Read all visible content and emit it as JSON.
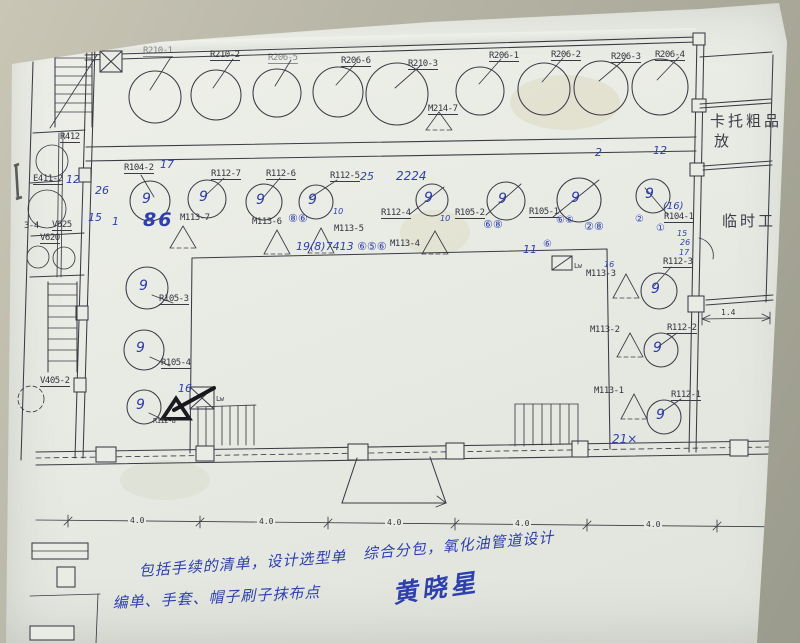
{
  "photo": {
    "background_color": "#b7b5a6",
    "paper_color": "#e9ece5",
    "ink_color": "#3a3b45",
    "pen_color": "#2e3fae"
  },
  "drawing": {
    "vessel_mark": "9",
    "vessels": [
      [
        155,
        97,
        26,
        [
          171,
          57,
          150,
          90
        ],
        0
      ],
      [
        216,
        95,
        25,
        [
          233,
          59,
          213,
          88
        ],
        0
      ],
      [
        277,
        93,
        24,
        [
          291,
          60,
          275,
          86
        ],
        0
      ],
      [
        338,
        92,
        25,
        [
          356,
          63,
          336,
          85
        ],
        0
      ],
      [
        397,
        94,
        31,
        [
          420,
          66,
          395,
          88
        ],
        0
      ],
      [
        480,
        91,
        24,
        [
          501,
          59,
          479,
          84
        ],
        0
      ],
      [
        544,
        89,
        26,
        [
          563,
          58,
          542,
          82
        ],
        0
      ],
      [
        601,
        88,
        27,
        [
          625,
          59,
          599,
          81
        ],
        0
      ],
      [
        660,
        87,
        28,
        [
          679,
          57,
          657,
          80
        ],
        0
      ],
      [
        150,
        201,
        20,
        [
          141,
          175,
          154,
          197
        ],
        1
      ],
      [
        207,
        199,
        19,
        [
          224,
          178,
          206,
          195
        ],
        1
      ],
      [
        264,
        202,
        18,
        [
          280,
          178,
          263,
          198
        ],
        1
      ],
      [
        316,
        202,
        17,
        [
          337,
          180,
          310,
          198
        ],
        1
      ],
      [
        432,
        200,
        16,
        [
          410,
          214,
          444,
          187
        ],
        1
      ],
      [
        506,
        201,
        19,
        [
          486,
          215,
          521,
          184
        ],
        1
      ],
      [
        579,
        200,
        22,
        [
          553,
          217,
          599,
          180
        ],
        1
      ],
      [
        653,
        196,
        17,
        [
          668,
          215,
          645,
          188
        ],
        1
      ],
      [
        147,
        288,
        21,
        [
          152,
          295,
          173,
          303
        ],
        1
      ],
      [
        144,
        350,
        20,
        [
          150,
          357,
          170,
          366
        ],
        1
      ],
      [
        144,
        407,
        17,
        [
          149,
          413,
          166,
          421
        ],
        1
      ],
      [
        659,
        291,
        18,
        [
          671,
          267,
          654,
          286
        ],
        1
      ],
      [
        661,
        350,
        17,
        [
          677,
          333,
          658,
          347
        ],
        1
      ],
      [
        664,
        417,
        17,
        [
          681,
          399,
          662,
          412
        ],
        1
      ]
    ],
    "triangles": [
      [
        439,
        112,
        13,
        18
      ],
      [
        183,
        226,
        13,
        22
      ],
      [
        277,
        230,
        13,
        24
      ],
      [
        321,
        228,
        13,
        25
      ],
      [
        435,
        231,
        13,
        23
      ],
      [
        626,
        274,
        13,
        24
      ],
      [
        630,
        333,
        13,
        24
      ],
      [
        634,
        394,
        13,
        25
      ]
    ]
  },
  "labels": [
    {
      "t": "R210-1",
      "x": 143,
      "y": 46,
      "c": "p pu fade",
      "n": "equipment-label"
    },
    {
      "t": "R210-2",
      "x": 210,
      "y": 50,
      "c": "p pu",
      "n": "equipment-label"
    },
    {
      "t": "R206-5",
      "x": 268,
      "y": 53,
      "c": "p pu fade",
      "n": "equipment-label"
    },
    {
      "t": "R206-6",
      "x": 341,
      "y": 56,
      "c": "p pu",
      "n": "equipment-label"
    },
    {
      "t": "R210-3",
      "x": 408,
      "y": 59,
      "c": "p pu",
      "n": "equipment-label"
    },
    {
      "t": "R206-1",
      "x": 489,
      "y": 51,
      "c": "p pu",
      "n": "equipment-label"
    },
    {
      "t": "R206-2",
      "x": 551,
      "y": 50,
      "c": "p pu",
      "n": "equipment-label"
    },
    {
      "t": "R206-3",
      "x": 611,
      "y": 52,
      "c": "p pu",
      "n": "equipment-label"
    },
    {
      "t": "R206-4",
      "x": 655,
      "y": 50,
      "c": "p pu",
      "n": "equipment-label"
    },
    {
      "t": "M214-7",
      "x": 428,
      "y": 104,
      "c": "p pu",
      "n": "equipment-label"
    },
    {
      "t": "R104-2",
      "x": 124,
      "y": 163,
      "c": "p pu",
      "n": "equipment-label"
    },
    {
      "t": "R112-7",
      "x": 211,
      "y": 169,
      "c": "p pu",
      "n": "equipment-label"
    },
    {
      "t": "R112-6",
      "x": 266,
      "y": 169,
      "c": "p pu",
      "n": "equipment-label"
    },
    {
      "t": "R112-5",
      "x": 330,
      "y": 171,
      "c": "p pu",
      "n": "equipment-label"
    },
    {
      "t": "R112-4",
      "x": 381,
      "y": 208,
      "c": "p pu",
      "n": "equipment-label"
    },
    {
      "t": "R105-2",
      "x": 455,
      "y": 208,
      "c": "p pu",
      "n": "equipment-label"
    },
    {
      "t": "R105-1",
      "x": 529,
      "y": 207,
      "c": "p pu",
      "n": "equipment-label"
    },
    {
      "t": "R104-1",
      "x": 664,
      "y": 212,
      "c": "p pu",
      "n": "equipment-label"
    },
    {
      "t": "M113-7",
      "x": 180,
      "y": 213,
      "c": "p",
      "n": "equipment-label"
    },
    {
      "t": "M113-6",
      "x": 252,
      "y": 217,
      "c": "p",
      "n": "equipment-label"
    },
    {
      "t": "M113-5",
      "x": 334,
      "y": 224,
      "c": "p",
      "n": "equipment-label"
    },
    {
      "t": "M113-4",
      "x": 390,
      "y": 239,
      "c": "p",
      "n": "equipment-label"
    },
    {
      "t": "M113-3",
      "x": 586,
      "y": 269,
      "c": "p",
      "n": "equipment-label"
    },
    {
      "t": "M113-2",
      "x": 590,
      "y": 325,
      "c": "p",
      "n": "equipment-label"
    },
    {
      "t": "M113-1",
      "x": 594,
      "y": 386,
      "c": "p",
      "n": "equipment-label"
    },
    {
      "t": "R112-3",
      "x": 663,
      "y": 257,
      "c": "p pu",
      "n": "equipment-label"
    },
    {
      "t": "R112-2",
      "x": 667,
      "y": 323,
      "c": "p pu",
      "n": "equipment-label"
    },
    {
      "t": "R112-1",
      "x": 671,
      "y": 390,
      "c": "p pu",
      "n": "equipment-label"
    },
    {
      "t": "R105-3",
      "x": 159,
      "y": 294,
      "c": "p pu",
      "n": "equipment-label"
    },
    {
      "t": "R105-4",
      "x": 161,
      "y": 358,
      "c": "p pu",
      "n": "equipment-label"
    },
    {
      "t": "R112-8",
      "x": 153,
      "y": 417,
      "c": "p",
      "s": 7,
      "n": "equipment-label"
    },
    {
      "t": "R412",
      "x": 60,
      "y": 132,
      "c": "p pu",
      "n": "equipment-label"
    },
    {
      "t": "E411-2",
      "x": 33,
      "y": 174,
      "c": "p pu",
      "n": "equipment-label"
    },
    {
      "t": "V625",
      "x": 52,
      "y": 220,
      "c": "p pu",
      "n": "equipment-label"
    },
    {
      "t": "3-4",
      "x": 24,
      "y": 221,
      "c": "p",
      "n": "equipment-label"
    },
    {
      "t": "V620",
      "x": 40,
      "y": 233,
      "c": "p pu",
      "n": "equipment-label"
    },
    {
      "t": "V405-2",
      "x": 40,
      "y": 376,
      "c": "p pu",
      "n": "equipment-label"
    },
    {
      "t": "Lw",
      "x": 216,
      "y": 395,
      "c": "p",
      "s": 7,
      "n": "lift-label"
    },
    {
      "t": "Lw",
      "x": 574,
      "y": 262,
      "c": "p",
      "s": 7,
      "n": "lift-label"
    },
    {
      "t": "卡托粗品",
      "x": 710,
      "y": 110,
      "c": "room",
      "n": "room-label"
    },
    {
      "t": "放",
      "x": 714,
      "y": 130,
      "c": "room",
      "n": "room-label"
    },
    {
      "t": "临时工",
      "x": 722,
      "y": 210,
      "c": "room",
      "n": "room-label"
    },
    {
      "t": "4.0",
      "x": 128,
      "y": 516,
      "c": "dim",
      "n": "dimension-label"
    },
    {
      "t": "4.0",
      "x": 257,
      "y": 517,
      "c": "dim",
      "n": "dimension-label"
    },
    {
      "t": "4.0",
      "x": 385,
      "y": 518,
      "c": "dim",
      "n": "dimension-label"
    },
    {
      "t": "4.0",
      "x": 513,
      "y": 519,
      "c": "dim",
      "n": "dimension-label"
    },
    {
      "t": "4.0",
      "x": 644,
      "y": 520,
      "c": "dim",
      "n": "dimension-label"
    },
    {
      "t": "4.0",
      "x": 770,
      "y": 521,
      "c": "dim",
      "n": "dimension-label"
    },
    {
      "t": "1.4",
      "x": 719,
      "y": 308,
      "c": "dim",
      "n": "dimension-label"
    },
    {
      "t": "17",
      "x": 160,
      "y": 158,
      "c": "pen",
      "n": "pen-annotation"
    },
    {
      "t": "26",
      "x": 95,
      "y": 184,
      "c": "pen",
      "n": "pen-annotation"
    },
    {
      "t": "15",
      "x": 88,
      "y": 211,
      "c": "pen",
      "n": "pen-annotation"
    },
    {
      "t": "1",
      "x": 112,
      "y": 215,
      "c": "pen",
      "n": "pen-annotation"
    },
    {
      "t": "86",
      "x": 143,
      "y": 209,
      "c": "pen big",
      "n": "pen-annotation"
    },
    {
      "t": "⑧⑥",
      "x": 288,
      "y": 212,
      "c": "pen",
      "n": "pen-annotation"
    },
    {
      "t": "10",
      "x": 333,
      "y": 207,
      "c": "pen sm",
      "n": "pen-annotation"
    },
    {
      "t": "25",
      "x": 360,
      "y": 170,
      "c": "pen",
      "n": "pen-annotation"
    },
    {
      "t": "2224",
      "x": 396,
      "y": 169,
      "c": "pen",
      "s": 12,
      "n": "pen-annotation"
    },
    {
      "t": "19(8)7413 ⑥⑤⑥",
      "x": 296,
      "y": 240,
      "c": "pen",
      "n": "pen-annotation"
    },
    {
      "t": "10",
      "x": 440,
      "y": 214,
      "c": "pen sm",
      "n": "pen-annotation"
    },
    {
      "t": "⑥⑧",
      "x": 483,
      "y": 218,
      "c": "pen",
      "n": "pen-annotation"
    },
    {
      "t": "11",
      "x": 523,
      "y": 243,
      "c": "pen",
      "n": "pen-annotation"
    },
    {
      "t": "⑥",
      "x": 543,
      "y": 239,
      "c": "pen",
      "s": 10,
      "n": "pen-annotation"
    },
    {
      "t": "⑥⑥",
      "x": 556,
      "y": 215,
      "c": "pen",
      "s": 10,
      "n": "pen-annotation"
    },
    {
      "t": "②⑧",
      "x": 584,
      "y": 220,
      "c": "pen",
      "n": "pen-annotation"
    },
    {
      "t": "(16)",
      "x": 663,
      "y": 201,
      "c": "pen",
      "s": 10,
      "n": "pen-annotation"
    },
    {
      "t": "②",
      "x": 635,
      "y": 214,
      "c": "pen",
      "s": 10,
      "n": "pen-annotation"
    },
    {
      "t": "①",
      "x": 656,
      "y": 223,
      "c": "pen",
      "s": 10,
      "n": "pen-annotation"
    },
    {
      "t": "15",
      "x": 677,
      "y": 229,
      "c": "pen sm",
      "n": "pen-annotation"
    },
    {
      "t": "26",
      "x": 680,
      "y": 238,
      "c": "pen sm",
      "n": "pen-annotation"
    },
    {
      "t": "17",
      "x": 679,
      "y": 248,
      "c": "pen sm",
      "n": "pen-annotation"
    },
    {
      "t": "2",
      "x": 595,
      "y": 146,
      "c": "pen",
      "n": "pen-annotation"
    },
    {
      "t": "12",
      "x": 653,
      "y": 144,
      "c": "pen",
      "n": "pen-annotation"
    },
    {
      "t": "12",
      "x": 66,
      "y": 173,
      "c": "pen",
      "n": "pen-annotation"
    },
    {
      "t": "2",
      "x": 2,
      "y": 428,
      "c": "pen",
      "n": "pen-annotation"
    },
    {
      "t": "16",
      "x": 178,
      "y": 382,
      "c": "pen",
      "n": "pen-annotation"
    },
    {
      "t": "16",
      "x": 604,
      "y": 260,
      "c": "pen sm",
      "n": "pen-annotation"
    },
    {
      "t": "21×",
      "x": 612,
      "y": 432,
      "c": "pen",
      "s": 12,
      "n": "pen-annotation"
    },
    {
      "t": "包括手续的清单，设计选型单",
      "x": 138,
      "y": 560,
      "c": "note",
      "r": -4,
      "n": "handwritten-note"
    },
    {
      "t": "编单、手套、帽子刷子抹布点",
      "x": 112,
      "y": 592,
      "c": "note",
      "r": -3,
      "n": "handwritten-note"
    },
    {
      "t": "综合分包，氧化油管道设计",
      "x": 362,
      "y": 543,
      "c": "note",
      "r": -5,
      "n": "handwritten-note"
    },
    {
      "t": "黄晓星",
      "x": 390,
      "y": 575,
      "c": "sig",
      "r": -8,
      "n": "signature"
    }
  ]
}
